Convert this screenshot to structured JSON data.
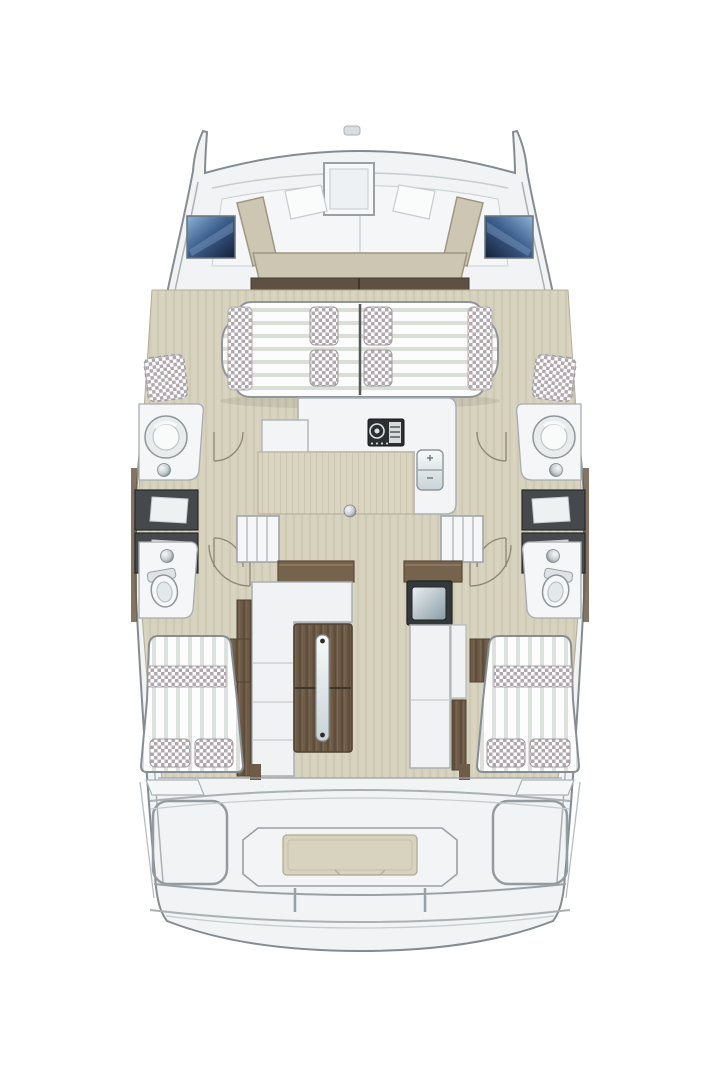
{
  "figure": {
    "type": "floorplan",
    "subject": "sailing-catamaran",
    "view": "top-down",
    "orientation": "bow-up"
  },
  "canvas": {
    "width": 720,
    "height": 1080,
    "background": "#ffffff"
  },
  "colors": {
    "page": "#ffffff",
    "hull_outline": "#858c91",
    "deck": "#f1f3f4",
    "deck_bright": "#f4f6f7",
    "panel_line": "#aab1b5",
    "panel_light": "#c6ccd0",
    "bench": "#cdc6b2",
    "bench_edge": "#9e9682",
    "beam_wood": "#5e5144",
    "floor": "#d5d1bd",
    "floor_line": "#c7c2ab",
    "floor_edge": "#b4ad97",
    "counter_oak": "#d9d5c1",
    "oak_line": "#cac5ae",
    "wood": "#6e5c48",
    "wood_dark": "#4f4234",
    "wood_grain": "#5f4e3c",
    "checker": "#b2a7ac",
    "checker_edge": "#a29a9e",
    "stripe_green": "#d9dfd6",
    "stripe_gray": "#dce1de",
    "window_deep": "#141f38",
    "window_mid": "#3f618f",
    "window_light": "#8fb3d8",
    "hatch_dark": "#45494c",
    "hatch_inner": "#eef1f2",
    "module_dark": "#33383b",
    "glass_light": "#e9f0f3",
    "glass_dark": "#8b9ba4",
    "metal_light": "#f6f8f9",
    "metal_dark": "#788086",
    "platform": "#d8d3bf",
    "fixture": "#f4f6f7",
    "stove_dark": "#2b2f31",
    "white": "#ffffff"
  },
  "layout_counts": {
    "hulls": 2,
    "bow_windows": 2,
    "forward_sunbed_pillows": 4,
    "side_deck_cushions": 2,
    "washbasins": 2,
    "toilets": 2,
    "hull_hatches": 4,
    "companionway_stairs": 2,
    "aft_cabin_beds": 2,
    "aft_cabin_pillows_per_bed": 2,
    "aft_cockpit_seats": 2
  },
  "parts": {
    "bow": [
      "port-bow-tip",
      "starboard-bow-tip",
      "anchor-fitting",
      "foredeck-hatch"
    ],
    "forward_cockpit": [
      "port-window",
      "starboard-window",
      "u-bench",
      "backrest-panels",
      "crossbeam"
    ],
    "forward_lounge": [
      "double-sunbed",
      "checker-pillows",
      "side-bolsters",
      "side-deck-cushions"
    ],
    "port_hull": [
      "washbasin",
      "toilet",
      "hull-hatches",
      "door-arcs",
      "companionway-stairs"
    ],
    "starboard_hull": [
      "washbasin",
      "toilet",
      "hull-hatches",
      "door-arcs",
      "companionway-stairs"
    ],
    "salon": [
      "galley-counter",
      "stove",
      "double-sink",
      "oak-worktop",
      "dining-table",
      "l-settee",
      "side-bench",
      "storage-module",
      "wood-floor"
    ],
    "aft": [
      "port-cabin-bed",
      "starboard-cabin-bed",
      "cockpit-seats",
      "tender-platform",
      "transom-steps"
    ]
  }
}
